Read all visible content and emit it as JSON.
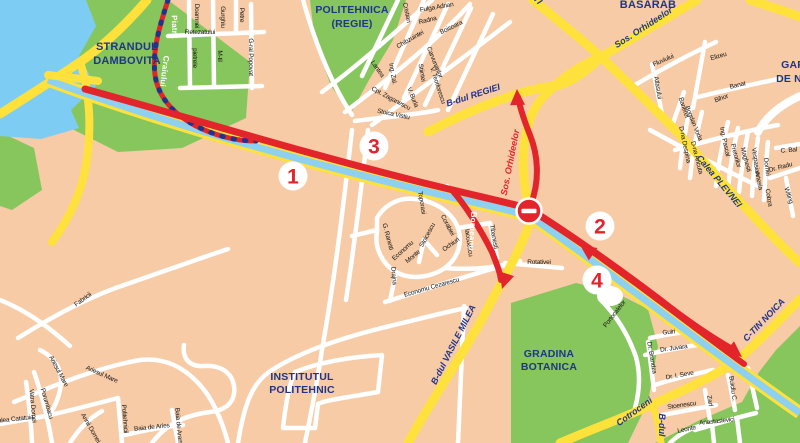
{
  "colors": {
    "background": "#f7cba6",
    "water": "#7dccf3",
    "park_green": "#86c65d",
    "road_yellow": "#ffe13b",
    "road_white": "#ffffff",
    "route_red": "#e2242b",
    "label_navy": "#1f348c",
    "street_black": "#141414"
  },
  "map": {
    "area_labels": [
      [
        "STRANDUL",
        127,
        50,
        0,
        11
      ],
      [
        "DAMBOVITA",
        127,
        64,
        0,
        11
      ],
      [
        "SPORTIVA",
        352,
        -2,
        0,
        10.5
      ],
      [
        "POLITEHNICA",
        352,
        13,
        0,
        10.5
      ],
      [
        "(REGIE)",
        352,
        27,
        0,
        10.5
      ],
      [
        "BASARAB",
        648,
        8,
        0,
        11
      ],
      [
        "GARA",
        797,
        68,
        0,
        10.5
      ],
      [
        "DE NORD",
        801,
        82,
        0,
        10.5
      ],
      [
        "GRADINA",
        549,
        357,
        0,
        10.5
      ],
      [
        "BOTANICA",
        549,
        370,
        0,
        10.5
      ],
      [
        "INSTITUTUL",
        302,
        380,
        0,
        10.5
      ],
      [
        "POLITEHNIC",
        302,
        393,
        0,
        10.5
      ]
    ],
    "road_labels": [
      [
        "B-dul REGIEI",
        474,
        98,
        -18
      ],
      [
        "Sos. Orhideelor",
        645,
        30,
        -33
      ],
      [
        "GIULESTI",
        524,
        -10,
        46
      ],
      [
        "Calea PLEVNEI",
        717,
        183,
        50
      ],
      [
        "B-dul VASILE MILEA",
        456,
        346,
        -63
      ],
      [
        "C-TIN NOICA",
        766,
        322,
        -46
      ],
      [
        "Cotroceni",
        636,
        414,
        -36
      ],
      [
        "B-dul",
        659,
        425,
        90
      ]
    ],
    "route_labels": [
      [
        "Sos. Orhideelor",
        513,
        163,
        -79
      ]
    ],
    "red_road_labels": [
      [
        "Piatra",
        172,
        27,
        88
      ],
      [
        "Craiului",
        162,
        71,
        97
      ],
      [
        "Borneanu",
        470,
        231,
        94
      ]
    ],
    "street_labels": [
      [
        "Retezatului",
        200,
        34,
        0
      ],
      [
        "Doamnei",
        195,
        16,
        90
      ],
      [
        "Gurghiu",
        221,
        17,
        90
      ],
      [
        "Petre",
        240,
        15,
        90
      ],
      [
        "pietrele",
        193,
        58,
        90
      ],
      [
        "M-til",
        218,
        56,
        90
      ],
      [
        "G-ral Popovat",
        249,
        57,
        90
      ],
      [
        "Cristian",
        405,
        13,
        78
      ],
      [
        "Fulga Adrian",
        437,
        9,
        -10
      ],
      [
        "Radna",
        428,
        22,
        -14
      ],
      [
        "Boisoara",
        452,
        29,
        -26
      ],
      [
        "Chibzuintei",
        411,
        41,
        -30
      ],
      [
        "Carvunarilor",
        433,
        63,
        68
      ],
      [
        "Lantea",
        376,
        70,
        55
      ],
      [
        "Ing. Zal.",
        391,
        74,
        80
      ],
      [
        "Stiintei",
        420,
        73,
        80
      ],
      [
        "V. Teodorescu",
        436,
        86,
        72
      ],
      [
        "V. Burla",
        411,
        98,
        68
      ],
      [
        "Cpt. Zaganescu",
        390,
        100,
        28
      ],
      [
        "Stoica Vistiu",
        393,
        116,
        12
      ],
      [
        "Fluviului",
        664,
        62,
        -24
      ],
      [
        "Atlasului",
        656,
        88,
        80
      ],
      [
        "Elizeu",
        719,
        58,
        -16
      ],
      [
        "Banat",
        738,
        87,
        -14
      ],
      [
        "Bihor",
        722,
        100,
        -20
      ],
      [
        "Barierei",
        682,
        108,
        72
      ],
      [
        "Bogdan Voda",
        692,
        124,
        68
      ],
      [
        "D-na Despina",
        683,
        145,
        78
      ],
      [
        "D-na Ancuta",
        695,
        158,
        76
      ],
      [
        "Ing. Pascal",
        723,
        142,
        78
      ],
      [
        "Pretorilor",
        734,
        156,
        75
      ],
      [
        "Maghesti",
        744,
        160,
        75
      ],
      [
        "Vespasian",
        754,
        162,
        82
      ],
      [
        "Dornei",
        765,
        167,
        82
      ],
      [
        "C. Bal",
        789,
        152,
        -5
      ],
      [
        "Dr. Radu",
        781,
        169,
        -15
      ],
      [
        "Artesia",
        757,
        181,
        78
      ],
      [
        "Cobza",
        767,
        198,
        80
      ],
      [
        "Witing",
        787,
        196,
        72
      ],
      [
        "G. Ranetti",
        386,
        237,
        75
      ],
      [
        "Economu",
        404,
        252,
        -42
      ],
      [
        "Monte",
        414,
        258,
        -40
      ],
      [
        "Stoicescu",
        429,
        236,
        -62
      ],
      [
        "Toporasi",
        420,
        203,
        80
      ],
      [
        "Corabiei",
        446,
        226,
        62
      ],
      [
        "Ochiuri",
        452,
        246,
        -36
      ],
      [
        "Iacobescu",
        467,
        243,
        82
      ],
      [
        "Drajna",
        392,
        276,
        85
      ],
      [
        "Economu Cezarescu",
        432,
        289,
        -16
      ],
      [
        "Tibanesti",
        492,
        237,
        80
      ],
      [
        "Rotativei",
        539,
        264,
        0
      ],
      [
        "Fabricii",
        84,
        301,
        -36
      ],
      [
        "Ariesul Mare",
        57,
        372,
        62
      ],
      [
        "Ariesul Mare",
        101,
        376,
        24
      ],
      [
        "Porumbacu",
        45,
        404,
        74
      ],
      [
        "Vatra Dornei",
        31,
        406,
        85
      ],
      [
        "Valea Catatuia",
        14,
        421,
        -6
      ],
      [
        "Arinii Dornei",
        89,
        429,
        60
      ],
      [
        "Politehnicii",
        123,
        419,
        85
      ],
      [
        "Baia de Aries",
        152,
        429,
        -6
      ],
      [
        "Baia de Arama",
        177,
        428,
        85
      ],
      [
        "Portocalelor",
        616,
        315,
        -52
      ],
      [
        "Guiri",
        669,
        334,
        -6
      ],
      [
        "Dr. Juvara",
        674,
        350,
        -8
      ],
      [
        "Dr. Brandza",
        650,
        358,
        80
      ],
      [
        "Dr. I. Seve",
        680,
        377,
        -10
      ],
      [
        "Stoenescu",
        682,
        407,
        -8
      ],
      [
        "Zarf",
        708,
        401,
        82
      ],
      [
        "Buicliu C.",
        731,
        389,
        82
      ],
      [
        "Anastasievici",
        717,
        423,
        -6
      ],
      [
        "Leonte",
        687,
        431,
        -12
      ]
    ],
    "route_markers": [
      [
        "1",
        293,
        176
      ],
      [
        "2",
        600,
        226
      ],
      [
        "3",
        374,
        146
      ],
      [
        "4",
        597,
        280
      ]
    ],
    "arrows": [
      [
        517,
        89,
        -92
      ],
      [
        742,
        357,
        38
      ],
      [
        580,
        245,
        215
      ],
      [
        502,
        289,
        108
      ]
    ],
    "no_entry_sign": [
      529,
      211
    ]
  }
}
